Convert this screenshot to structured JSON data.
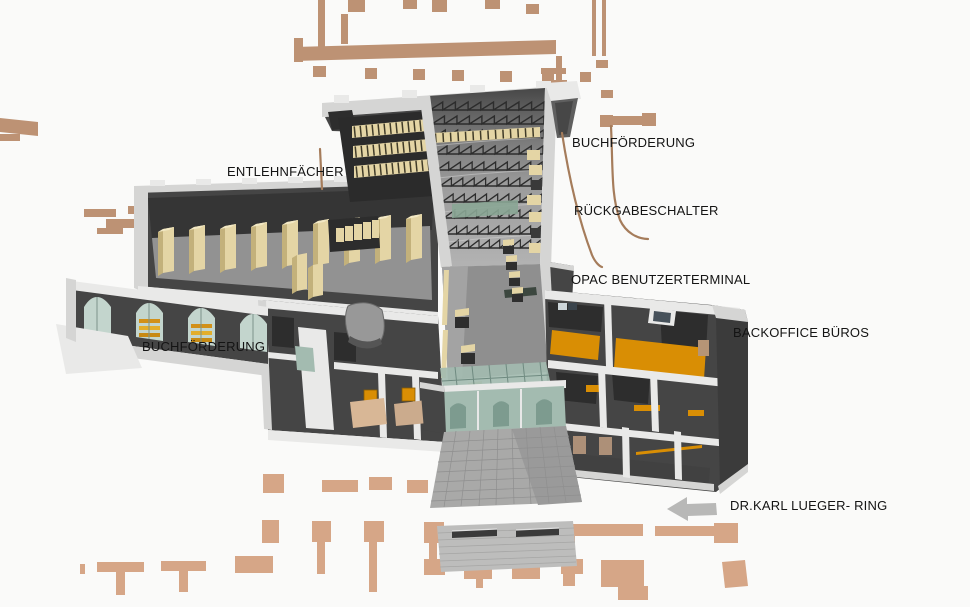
{
  "palette": {
    "background": "#fafaf9",
    "context_tan": "#bd9274",
    "context_tan_light": "#d6a687",
    "wall_dark": "#454545",
    "wall_darker": "#2d2d2d",
    "slab_light": "#d5d5d4",
    "cap_white": "#e9e9e8",
    "floor_gray": "#929292",
    "floor_orange": "#d98e04",
    "shelf_beige": "#e4d5a5",
    "shelf_beige_dark": "#c3b17b",
    "glass_green": "#a3bbb0",
    "glass_green_dark": "#7d9b8f",
    "stone_gray": "#a9a9a8",
    "leader_brown": "#a57c5b",
    "arrow_gray": "#b8b8b7",
    "label_text": "#141414"
  },
  "labels": {
    "entlehnfaecher": "ENTLEHNFÄCHER",
    "buchfoerderung_top": "BUCHFÖRDERUNG",
    "rueckgabeschalter": "RÜCKGABESCHALTER",
    "opac_benutzerterminal": "OPAC BENUTZERTERMINAL",
    "backoffice_bueros": "BACKOFFICE BÜROS",
    "buchfoerderung_left": "BUCHFÖRDERUNG",
    "street_name": "DR.KARL LUEGER- RING"
  },
  "arrow": {
    "direction": "left"
  }
}
